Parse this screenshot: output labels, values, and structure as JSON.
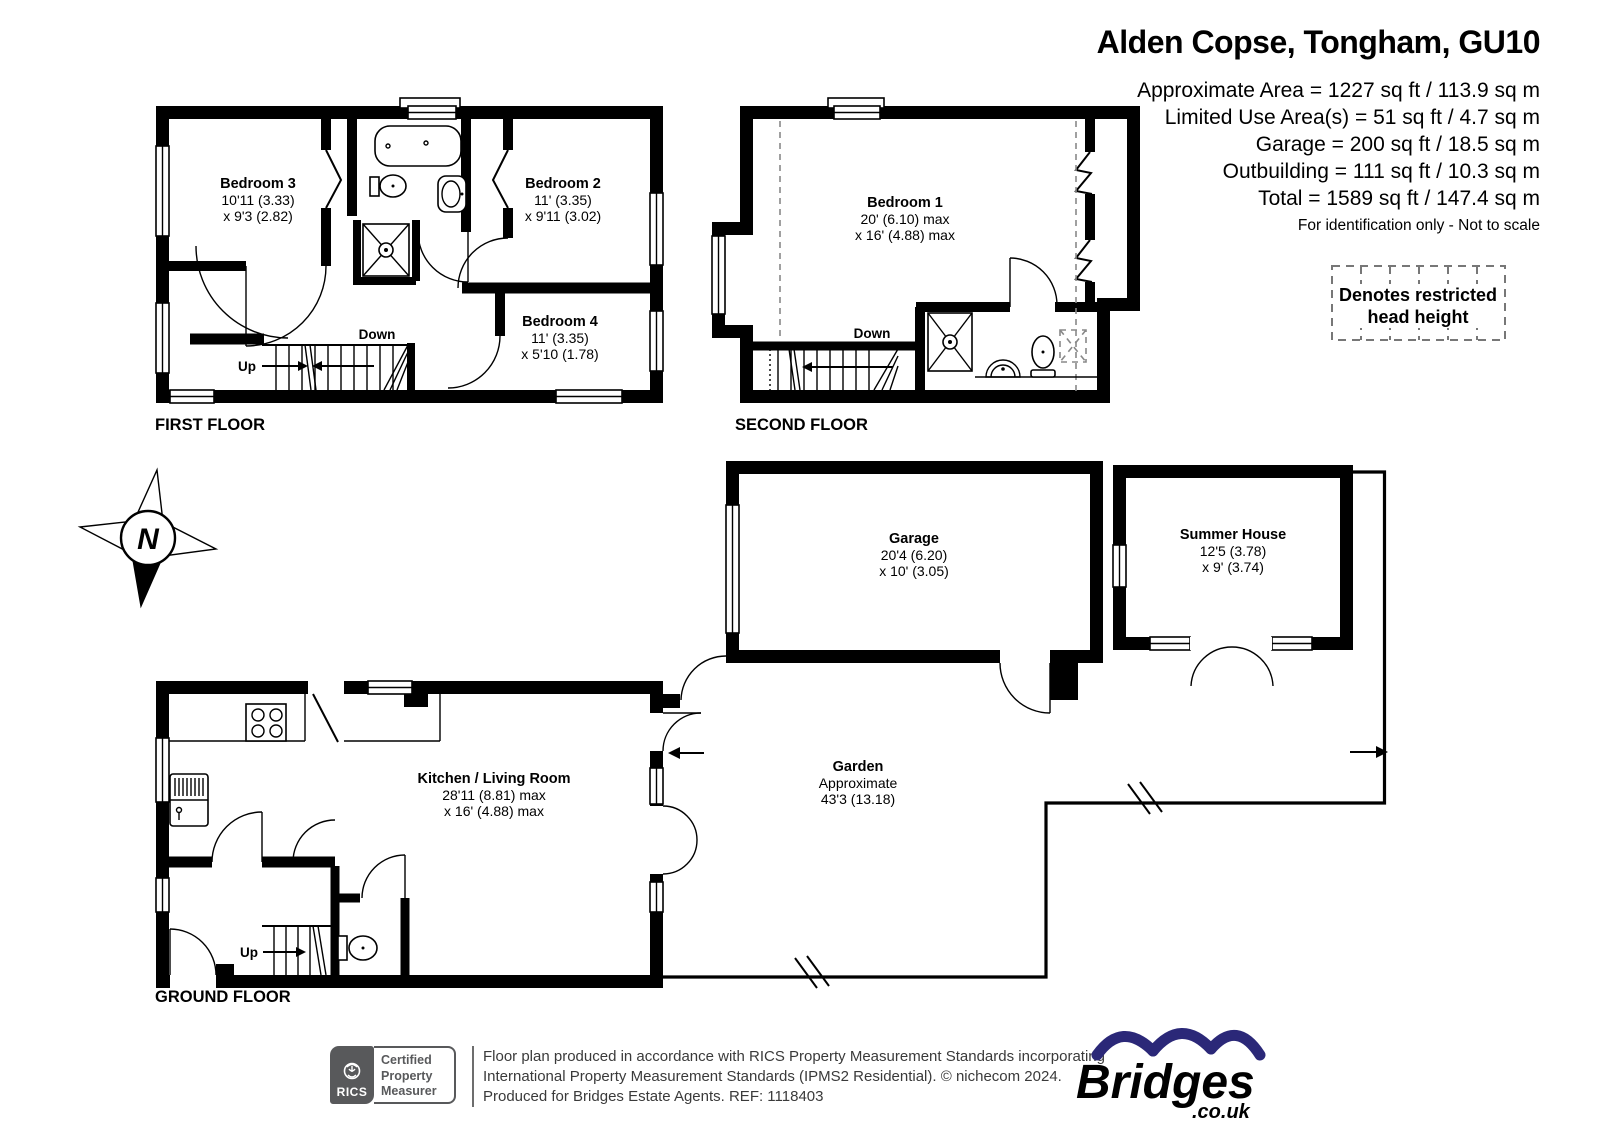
{
  "header": {
    "title": "Alden Copse, Tongham, GU10",
    "lines": [
      "Approximate Area = 1227 sq ft / 113.9 sq m",
      "Limited Use Area(s) = 51 sq ft / 4.7 sq m",
      "Garage = 200 sq ft / 18.5 sq m",
      "Outbuilding = 111 sq ft / 10.3 sq m",
      "Total = 1589 sq ft / 147.4 sq m"
    ],
    "note": "For identification only - Not to scale"
  },
  "legend": {
    "line1": "Denotes restricted",
    "line2": "head height"
  },
  "compass": {
    "label": "N"
  },
  "floors": {
    "first": {
      "label": "FIRST FLOOR",
      "bedroom3": {
        "name": "Bedroom 3",
        "dim1": "10'11 (3.33)",
        "dim2": "x 9'3 (2.82)"
      },
      "bedroom2": {
        "name": "Bedroom 2",
        "dim1": "11' (3.35)",
        "dim2": "x 9'11 (3.02)"
      },
      "bedroom4": {
        "name": "Bedroom 4",
        "dim1": "11' (3.35)",
        "dim2": "x 5'10 (1.78)"
      },
      "up": "Up",
      "down": "Down"
    },
    "second": {
      "label": "SECOND FLOOR",
      "bedroom1": {
        "name": "Bedroom 1",
        "dim1": "20' (6.10) max",
        "dim2": "x 16' (4.88) max"
      },
      "down": "Down"
    },
    "ground": {
      "label": "GROUND FLOOR",
      "kitchen": {
        "name": "Kitchen / Living Room",
        "dim1": "28'11 (8.81) max",
        "dim2": "x 16' (4.88) max"
      },
      "garden": {
        "name": "Garden",
        "dim1": "Approximate",
        "dim2": "43'3 (13.18)"
      },
      "up": "Up"
    },
    "garage": {
      "name": "Garage",
      "dim1": "20'4 (6.20)",
      "dim2": "x 10' (3.05)"
    },
    "summer_house": {
      "name": "Summer House",
      "dim1": "12'5 (3.78)",
      "dim2": "x 9' (3.74)"
    }
  },
  "footer": {
    "rics": {
      "brand": "RICS",
      "certification": [
        "Certified",
        "Property",
        "Measurer"
      ]
    },
    "disclaimer_lines": [
      "Floor plan produced in accordance with RICS Property Measurement Standards incorporating",
      "International Property Measurement Standards (IPMS2 Residential).   © nichecom 2024.",
      "Produced for Bridges Estate Agents.   REF: 1118403"
    ],
    "bridges": {
      "brand": "Bridges",
      "suffix": ".co.uk"
    }
  },
  "colors": {
    "wall": "#000000",
    "bridges_blue": "#2b2878",
    "rics_gray": "#58595b"
  }
}
